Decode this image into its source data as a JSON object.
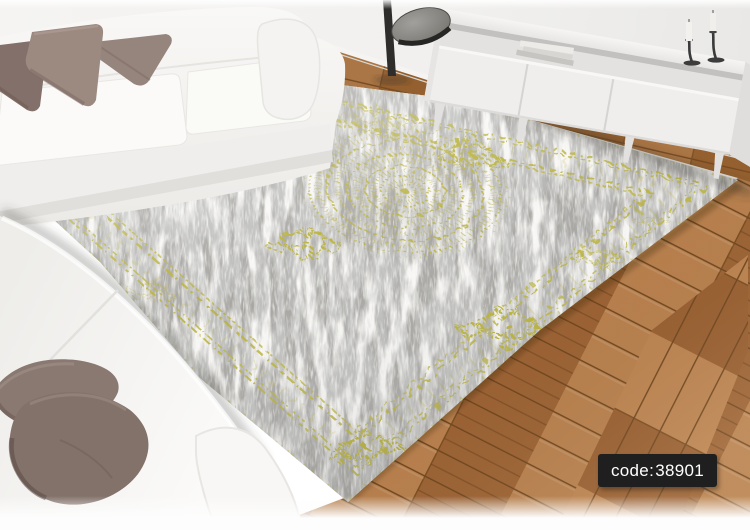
{
  "badge": {
    "label": "code:",
    "value": "38901"
  },
  "scene": {
    "description": "Distressed grey area rug with yellow lace medallion and yellow border motifs, shown in a living room with two white sofas, taupe cushions, a white TV stand with candlesticks and books, and a chevron parquet wood floor"
  },
  "palette": {
    "rug_grey": "#a8a7a4",
    "rug_light": "#dcdbd8",
    "rug_accent": "#b9b23a",
    "wood_mid": "#a9713f",
    "wood_dark": "#8e5a2e",
    "wood_light": "#c08a55",
    "sofa_white": "#f6f5f3",
    "pillow_taupe": "#8c7970",
    "wall": "#f1f0ee",
    "badge_bg": "#1f1f1f",
    "badge_text": "#ffffff"
  }
}
